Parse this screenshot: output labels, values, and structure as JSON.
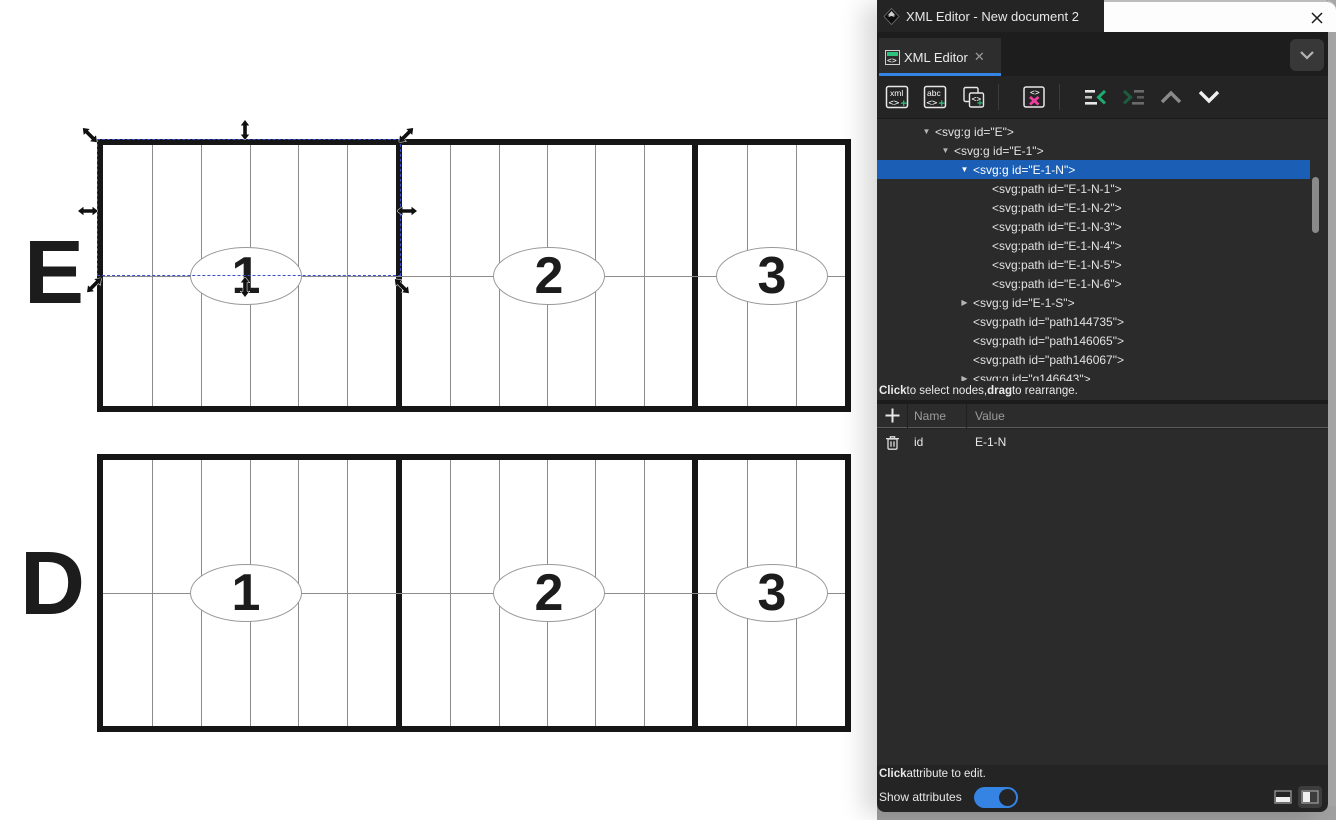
{
  "window": {
    "icon": "inkscape-logo-icon",
    "title": "XML Editor - New document 2",
    "close_glyph": "✕"
  },
  "tab": {
    "label": "XML Editor",
    "close_glyph": "✕",
    "menu_glyph": "⌄"
  },
  "toolbar": {
    "buttons": [
      {
        "name": "new-element-node",
        "label": "xml"
      },
      {
        "name": "new-text-node",
        "label": "abc"
      },
      {
        "name": "duplicate-node",
        "label": ""
      },
      {
        "name": "delete-node",
        "label": ""
      },
      {
        "name": "unindent-node",
        "label": ""
      },
      {
        "name": "indent-node",
        "label": "",
        "disabled": true
      },
      {
        "name": "move-node-up",
        "label": "",
        "disabled": true
      },
      {
        "name": "move-node-down",
        "label": ""
      }
    ]
  },
  "tree": {
    "nodes": [
      {
        "depth": 0,
        "state": "open",
        "tag": "<svg:g id=\"E\">"
      },
      {
        "depth": 1,
        "state": "open",
        "tag": "<svg:g id=\"E-1\">"
      },
      {
        "depth": 2,
        "state": "open",
        "tag": "<svg:g id=\"E-1-N\">",
        "selected": true
      },
      {
        "depth": 3,
        "state": "leaf",
        "tag": "<svg:path id=\"E-1-N-1\">"
      },
      {
        "depth": 3,
        "state": "leaf",
        "tag": "<svg:path id=\"E-1-N-2\">"
      },
      {
        "depth": 3,
        "state": "leaf",
        "tag": "<svg:path id=\"E-1-N-3\">"
      },
      {
        "depth": 3,
        "state": "leaf",
        "tag": "<svg:path id=\"E-1-N-4\">"
      },
      {
        "depth": 3,
        "state": "leaf",
        "tag": "<svg:path id=\"E-1-N-5\">"
      },
      {
        "depth": 3,
        "state": "leaf",
        "tag": "<svg:path id=\"E-1-N-6\">"
      },
      {
        "depth": 2,
        "state": "collapsed",
        "tag": "<svg:g id=\"E-1-S\">"
      },
      {
        "depth": 2,
        "state": "leaf",
        "tag": "<svg:path id=\"path144735\">"
      },
      {
        "depth": 2,
        "state": "leaf",
        "tag": "<svg:path id=\"path146065\">"
      },
      {
        "depth": 2,
        "state": "leaf",
        "tag": "<svg:path id=\"path146067\">"
      },
      {
        "depth": 2,
        "state": "collapsed",
        "tag": "<svg:g id=\"g146643\">"
      }
    ],
    "hint_segments": [
      {
        "text": "Click",
        "bold": true
      },
      {
        "text": " to select nodes, ",
        "bold": false
      },
      {
        "text": "drag",
        "bold": true
      },
      {
        "text": " to rearrange.",
        "bold": false
      }
    ]
  },
  "attributes": {
    "columns": [
      "Name",
      "Value"
    ],
    "rows": [
      {
        "name": "id",
        "value": "E-1-N"
      }
    ],
    "hint_segments": [
      {
        "text": "Click",
        "bold": true
      },
      {
        "text": " attribute to edit.",
        "bold": false
      }
    ]
  },
  "footer": {
    "show_attributes_label": "Show attributes",
    "toggle_on": true,
    "layout_buttons": [
      "horizontal-split-layout",
      "vertical-split-layout"
    ]
  },
  "canvas": {
    "rows": [
      {
        "label": "E",
        "sections": [
          {
            "number": "1",
            "columns": 6
          },
          {
            "number": "2",
            "columns": 6
          },
          {
            "number": "3",
            "columns": 3
          }
        ]
      },
      {
        "label": "D",
        "sections": [
          {
            "number": "1",
            "columns": 6
          },
          {
            "number": "2",
            "columns": 6
          },
          {
            "number": "3",
            "columns": 3
          }
        ]
      }
    ],
    "selection": {
      "node_id": "E-1-N",
      "region": "top half of section 1 of row E"
    }
  },
  "colors": {
    "accent": "#3584e4",
    "tree_selection": "#1b5eb5",
    "green_plus": "#2ec27e",
    "delete_magenta": "#f03da0",
    "panel_bg": "#242424",
    "content_bg": "#2b2b2b",
    "stroke": "#161616"
  }
}
